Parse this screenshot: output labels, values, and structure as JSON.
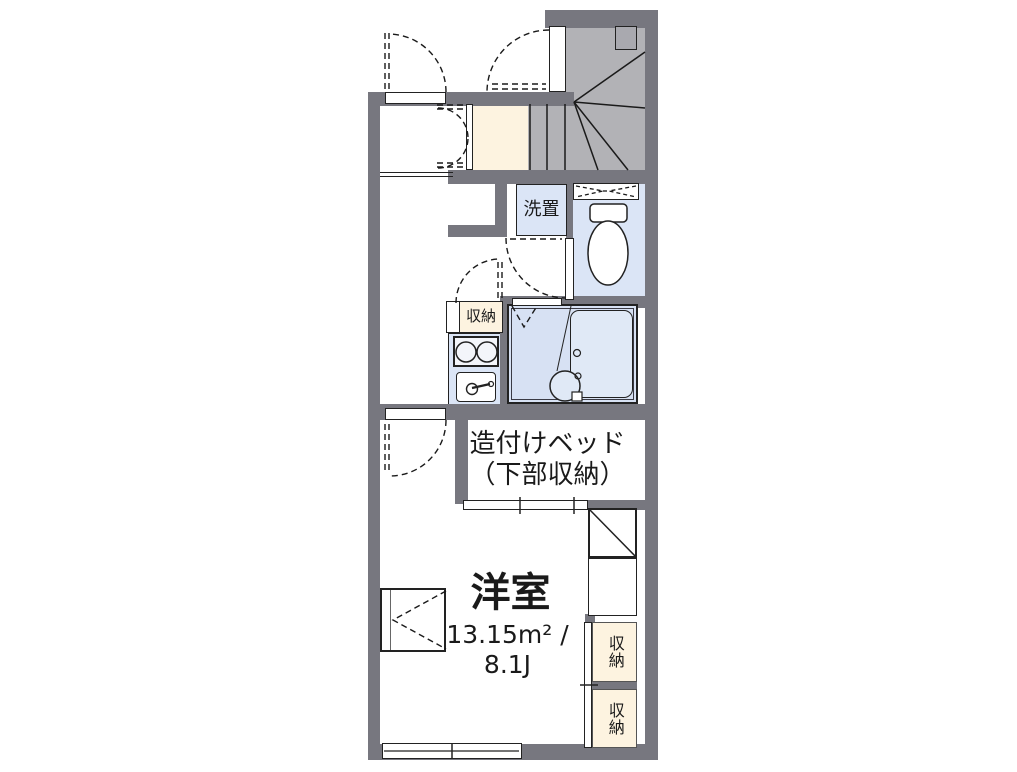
{
  "palette": {
    "wall": "#77777f",
    "stair": "#b2b2b6",
    "stair_landing": "#a9a9af",
    "cream": "#fdf3e0",
    "lightblue": "#dbe5f6",
    "bath": "#d7e1f3",
    "stroke": "#1a1a1a"
  },
  "labels": {
    "washer": "洗置",
    "hall_storage": "収納",
    "bed_line1": "造付けベッド",
    "bed_line2": "（下部収納）",
    "room_name": "洋室",
    "room_area": "13.15m² /",
    "room_tatami": "8.1J",
    "closet_top": "収納",
    "closet_bottom": "収納"
  }
}
